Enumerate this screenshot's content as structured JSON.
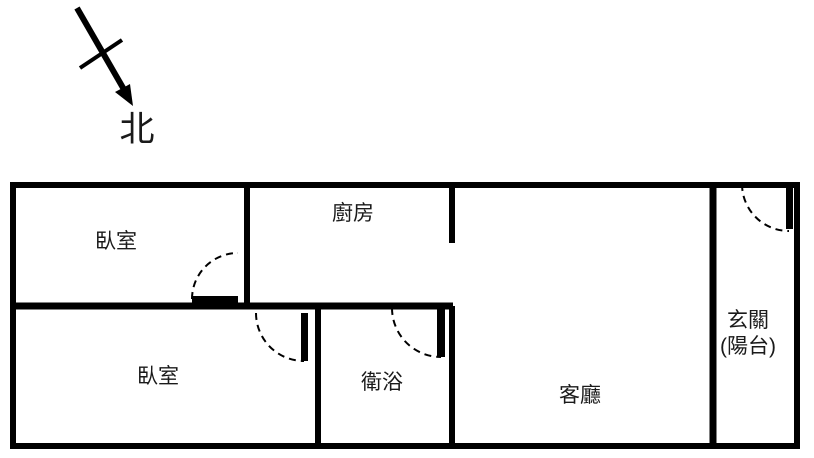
{
  "compass": {
    "label": "北"
  },
  "rooms": {
    "bedroom_top": "臥室",
    "kitchen": "廚房",
    "bedroom_bottom": "臥室",
    "bathroom": "衛浴",
    "living_room": "客廳",
    "entrance_line1": "玄關",
    "entrance_line2": "(陽台)"
  },
  "colors": {
    "wall": "#000000",
    "text": "#1a1a1a",
    "background": "#ffffff"
  }
}
